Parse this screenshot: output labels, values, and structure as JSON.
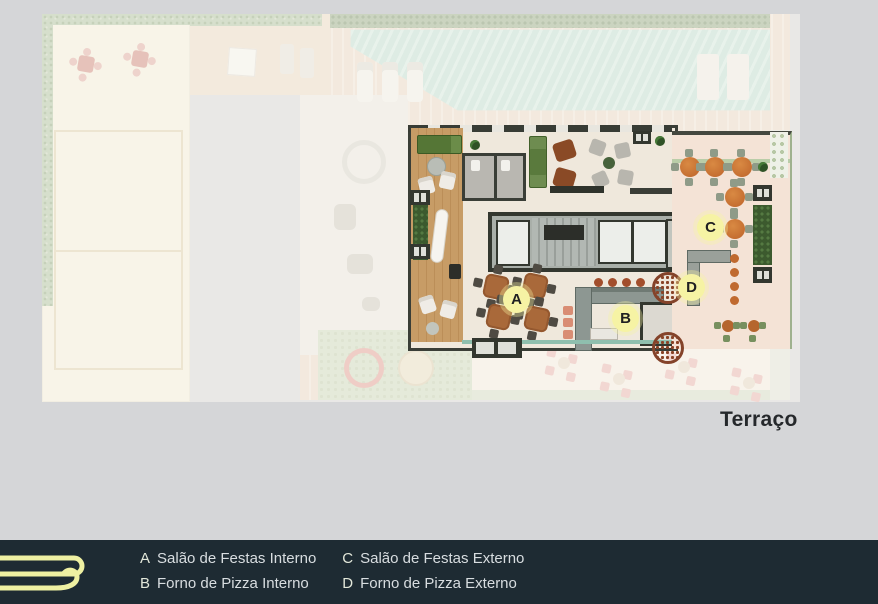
{
  "plan": {
    "title": "Terraço"
  },
  "legend": {
    "entries": [
      {
        "letter": "A",
        "label": "Salão de Festas Interno"
      },
      {
        "letter": "B",
        "label": "Forno de Pizza Interno"
      },
      {
        "letter": "C",
        "label": "Salão de Festas Externo"
      },
      {
        "letter": "D",
        "label": "Forno de Pizza Externo"
      }
    ]
  },
  "colors": {
    "footer_bg": "#1e2b33",
    "logo_yellow": "#eef0a2",
    "marker_yellow": "#f6f3a4",
    "legend_text": "#d8dde0",
    "pool_teal": "#bcded3",
    "deck_wood": "#c79c66"
  }
}
